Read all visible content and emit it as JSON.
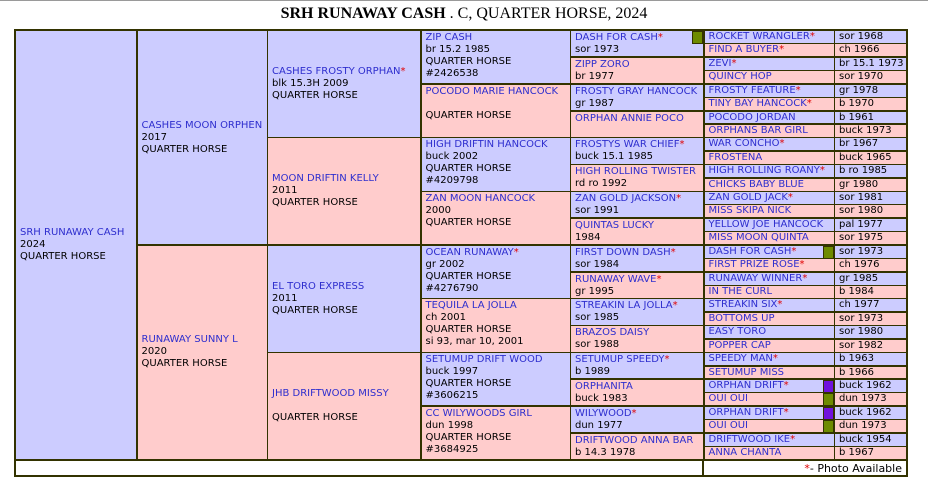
{
  "title": {
    "name": "SRH RUNAWAY CASH",
    "suffix": " . C, QUARTER HORSE, 2024"
  },
  "marks": {
    "asterisk": "*"
  },
  "footer": {
    "asterisk": "*",
    "text": " - Photo Available"
  },
  "colors": {
    "sire_bg": "#CCCCFF",
    "dam_bg": "#FFCCCC",
    "border": "#333300",
    "name_link_blue": "#2E2ECE",
    "asterisk_red": "#E00000",
    "photo_box_green": "#6E8B00",
    "photo_box_purple": "#7012DC"
  },
  "generations": {
    "g1": [
      {
        "name": "SRH RUNAWAY CASH",
        "lines": [
          "2024",
          "QUARTER HORSE"
        ]
      }
    ],
    "g2": [
      {
        "name": "CASHES MOON ORPHEN",
        "lines": [
          "2017",
          "QUARTER HORSE"
        ]
      },
      {
        "name": "RUNAWAY SUNNY L",
        "lines": [
          "2020",
          "QUARTER HORSE"
        ]
      }
    ],
    "g3": [
      {
        "name": "CASHES FROSTY ORPHAN",
        "asterisk": true,
        "lines": [
          "blk 15.3H 2009",
          "QUARTER HORSE"
        ]
      },
      {
        "name": "MOON DRIFTIN KELLY",
        "lines": [
          "2011",
          "QUARTER HORSE"
        ]
      },
      {
        "name": "EL TORO EXPRESS",
        "lines": [
          "2011",
          "QUARTER HORSE"
        ]
      },
      {
        "name": "JHB DRIFTWOOD MISSY",
        "lines": [
          "",
          "QUARTER HORSE"
        ]
      }
    ],
    "g4": [
      {
        "name": "ZIP CASH",
        "lines": [
          "br 15.2 1985",
          "QUARTER HORSE",
          "#2426538"
        ]
      },
      {
        "name": "POCODO MARIE HANCOCK",
        "lines": [
          "",
          "QUARTER HORSE"
        ]
      },
      {
        "name": "HIGH DRIFTIN HANCOCK",
        "lines": [
          "buck 2002",
          "QUARTER HORSE",
          "#4209798"
        ]
      },
      {
        "name": "ZAN MOON HANCOCK",
        "lines": [
          "2000",
          "QUARTER HORSE"
        ]
      },
      {
        "name": "OCEAN RUNAWAY",
        "asterisk": true,
        "lines": [
          "gr 2002",
          "QUARTER HORSE",
          "#4276790"
        ]
      },
      {
        "name": "TEQUILA LA JOLLA",
        "lines": [
          "ch 2001",
          "QUARTER HORSE",
          "si 93, mar 10, 2001"
        ]
      },
      {
        "name": "SETUMUP DRIFT WOOD",
        "lines": [
          "buck 1997",
          "QUARTER HORSE",
          "#3606215"
        ]
      },
      {
        "name": "CC WILYWOODS GIRL",
        "lines": [
          "dun 1998",
          "QUARTER HORSE",
          "#3684925"
        ]
      }
    ],
    "g5": [
      {
        "name": "DASH FOR CASH",
        "asterisk": true,
        "photo_box": "green",
        "lines": [
          "sor 1973"
        ]
      },
      {
        "name": "ZIPP ZORO",
        "lines": [
          "br 1977"
        ]
      },
      {
        "name": "FROSTY GRAY HANCOCK",
        "lines": [
          "gr 1987"
        ]
      },
      {
        "name": "ORPHAN ANNIE POCO",
        "lines": [
          ""
        ]
      },
      {
        "name": "FROSTYS WAR CHIEF",
        "asterisk": true,
        "lines": [
          "buck 15.1 1985"
        ]
      },
      {
        "name": "HIGH ROLLING TWISTER",
        "lines": [
          "rd ro 1992"
        ]
      },
      {
        "name": "ZAN GOLD JACKSON",
        "asterisk": true,
        "lines": [
          "sor 1991"
        ]
      },
      {
        "name": "QUINTAS LUCKY",
        "lines": [
          "1984"
        ]
      },
      {
        "name": "FIRST DOWN DASH",
        "asterisk": true,
        "lines": [
          "sor 1984"
        ]
      },
      {
        "name": "RUNAWAY WAVE",
        "asterisk": true,
        "lines": [
          "gr 1995"
        ]
      },
      {
        "name": "STREAKIN LA JOLLA",
        "asterisk": true,
        "lines": [
          "sor 1985"
        ]
      },
      {
        "name": "BRAZOS DAISY",
        "lines": [
          "sor 1988"
        ]
      },
      {
        "name": "SETUMUP SPEEDY",
        "asterisk": true,
        "lines": [
          "b 1989"
        ]
      },
      {
        "name": "ORPHANITA",
        "lines": [
          "buck 1983"
        ]
      },
      {
        "name": "WILYWOOD",
        "asterisk": true,
        "lines": [
          "dun 1977"
        ]
      },
      {
        "name": "DRIFTWOOD ANNA BAR",
        "lines": [
          "b 14.3 1978"
        ]
      }
    ],
    "g6": [
      {
        "name": "ROCKET WRANGLER",
        "asterisk": true,
        "detail": "sor 1968"
      },
      {
        "name": "FIND A BUYER",
        "asterisk": true,
        "detail": "ch 1966"
      },
      {
        "name": "ZEVI",
        "asterisk": true,
        "detail": "br 15.1 1973"
      },
      {
        "name": "QUINCY HOP",
        "detail": "sor 1970"
      },
      {
        "name": "FROSTY FEATURE",
        "asterisk": true,
        "detail": "gr 1978"
      },
      {
        "name": "TINY BAY HANCOCK",
        "asterisk": true,
        "detail": "b 1970"
      },
      {
        "name": "POCODO JORDAN",
        "detail": "b 1961"
      },
      {
        "name": "ORPHANS BAR GIRL",
        "detail": "buck 1973"
      },
      {
        "name": "WAR CONCHO",
        "asterisk": true,
        "detail": "br 1967"
      },
      {
        "name": "FROSTENA",
        "detail": "buck 1965"
      },
      {
        "name": "HIGH ROLLING ROANY",
        "asterisk": true,
        "detail": "b ro 1985"
      },
      {
        "name": "CHICKS BABY BLUE",
        "detail": "gr 1980"
      },
      {
        "name": "ZAN GOLD JACK",
        "asterisk": true,
        "detail": "sor 1981"
      },
      {
        "name": "MISS SKIPA NICK",
        "detail": "sor 1980"
      },
      {
        "name": "YELLOW JOE HANCOCK",
        "detail": "pal 1977"
      },
      {
        "name": "MISS MOON QUINTA",
        "detail": "sor 1975"
      },
      {
        "name": "DASH FOR CASH",
        "asterisk": true,
        "photo_box": "green",
        "detail": "sor 1973"
      },
      {
        "name": "FIRST PRIZE ROSE",
        "asterisk": true,
        "detail": "ch 1976"
      },
      {
        "name": "RUNAWAY WINNER",
        "asterisk": true,
        "detail": "gr 1985"
      },
      {
        "name": "IN THE CURL",
        "detail": "b 1984"
      },
      {
        "name": "STREAKIN SIX",
        "asterisk": true,
        "detail": "ch 1977"
      },
      {
        "name": "BOTTOMS UP",
        "detail": "sor 1973"
      },
      {
        "name": "EASY TORO",
        "detail": "sor 1980"
      },
      {
        "name": "POPPER CAP",
        "detail": "sor 1982"
      },
      {
        "name": "SPEEDY MAN",
        "asterisk": true,
        "detail": "b 1963"
      },
      {
        "name": "SETUMUP MISS",
        "detail": "b 1966"
      },
      {
        "name": "ORPHAN DRIFT",
        "asterisk": true,
        "photo_box": "purple",
        "detail": "buck 1962"
      },
      {
        "name": "OUI OUI",
        "photo_box": "green",
        "detail": "dun 1973"
      },
      {
        "name": "ORPHAN DRIFT",
        "asterisk": true,
        "photo_box": "purple",
        "detail": "buck 1962"
      },
      {
        "name": "OUI OUI",
        "photo_box": "green",
        "detail": "dun 1973"
      },
      {
        "name": "DRIFTWOOD IKE",
        "asterisk": true,
        "detail": "buck 1954"
      },
      {
        "name": "ANNA CHANTA",
        "detail": "b 1967"
      }
    ]
  }
}
